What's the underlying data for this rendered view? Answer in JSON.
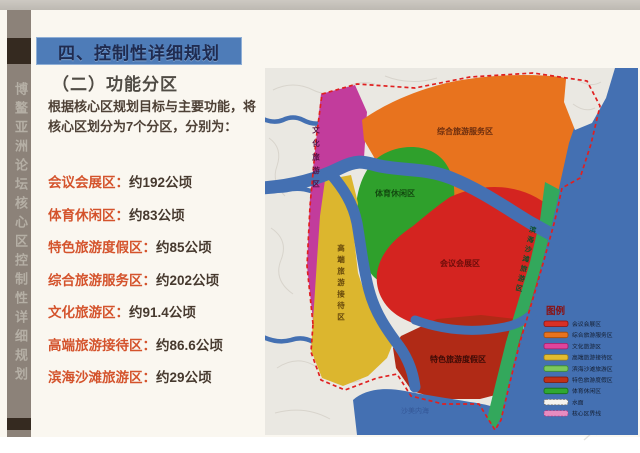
{
  "slide": {
    "vertical_banner": "博鳌亚洲论坛核心区控制性详细规划",
    "section_title": "四、控制性详细规划",
    "subsection_title": "（二）功能分区",
    "intro": "根据核心区规划目标与主要功能，将核心区划分为7个分区，分别为：",
    "zones": [
      {
        "label": "会议会展区：",
        "value": "约192公顷"
      },
      {
        "label": "体育休闲区：",
        "value": "约83公顷"
      },
      {
        "label": "特色旅游度假区：",
        "value": "约85公顷"
      },
      {
        "label": "综合旅游服务区：",
        "value": "约202公顷"
      },
      {
        "label": "文化旅游区：",
        "value": "约91.4公顷"
      },
      {
        "label": "高端旅游接待区：",
        "value": "约86.6公顷"
      },
      {
        "label": "滨海沙滩旅游区：",
        "value": "约29公顷"
      }
    ]
  },
  "map": {
    "zone_labels": {
      "comprehensive_tourism_service": "综合旅游服务区",
      "sports_leisure": "体育休闲区",
      "conference_exhibition": "会议会展区",
      "featured_tourism_resort": "特色旅游度假区",
      "cultural_tourism": "文化旅游区",
      "highend_reception": "高端旅游接待区",
      "coastal_beach": "滨海沙滩旅游区",
      "water_body": "沙美内海"
    },
    "legend": {
      "title": "图例",
      "items": [
        {
          "label": "会议会展区",
          "color": "#d93025"
        },
        {
          "label": "综合旅游服务区",
          "color": "#e8731e"
        },
        {
          "label": "文化旅游区",
          "color": "#e0449c"
        },
        {
          "label": "高端旅游接待区",
          "color": "#e2bc2f"
        },
        {
          "label": "滨海沙滩旅游区",
          "color": "#7cc95c"
        },
        {
          "label": "特色旅游度假区",
          "color": "#c03018"
        },
        {
          "label": "体育休闲区",
          "color": "#2fa832"
        },
        {
          "label": "水面",
          "color": "#f5f3ee"
        },
        {
          "label": "核心区界线",
          "color": "#e88cc0"
        }
      ]
    }
  },
  "colors": {
    "title_bar_bg": "#4e7cb8",
    "sidebar_bg": "#8c8279",
    "zone_name_text": "#d4532c",
    "sea": "#4470b2",
    "core_boundary": "#e02020",
    "content_bg": "#faf7f0"
  }
}
